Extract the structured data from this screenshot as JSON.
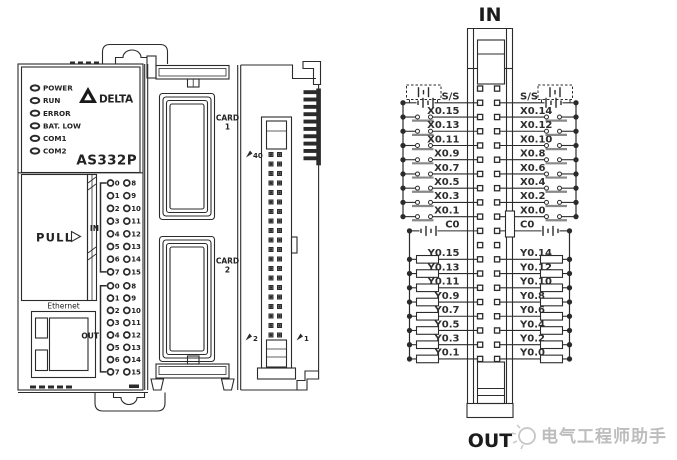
{
  "device": {
    "brand": "DELTA",
    "model": "AS332P",
    "status_leds": [
      "POWER",
      "RUN",
      "ERROR",
      "BAT. LOW",
      "COM1",
      "COM2"
    ],
    "pull_label": "PULL",
    "ethernet_label": "Ethernet",
    "in_group_label": "IN",
    "out_group_label": "OUT",
    "led_numbers_col1": [
      "0",
      "1",
      "2",
      "3",
      "4",
      "5",
      "6",
      "7"
    ],
    "led_numbers_col2": [
      "8",
      "9",
      "10",
      "11",
      "12",
      "13",
      "14",
      "15"
    ],
    "card1_line1": "CARD",
    "card1_line2": "1",
    "card2_line1": "CARD",
    "card2_line2": "2",
    "pin40_marker": "40",
    "pin2_marker": "2",
    "pin1_marker": "1"
  },
  "wiring": {
    "in_title": "IN",
    "out_title": "OUT",
    "left_labels": [
      "S/S",
      "X0.15",
      "X0.13",
      "X0.11",
      "X0.9",
      "X0.7",
      "X0.5",
      "X0.3",
      "X0.1",
      "C0",
      "Y0.15",
      "Y0.13",
      "Y0.11",
      "Y0.9",
      "Y0.7",
      "Y0.5",
      "Y0.3",
      "Y0.1"
    ],
    "right_labels": [
      "S/S",
      "X0.14",
      "X0.12",
      "X0.10",
      "X0.8",
      "X0.6",
      "X0.4",
      "X0.2",
      "X0.0",
      "C0",
      "Y0.14",
      "Y0.12",
      "Y0.10",
      "Y0.8",
      "Y0.6",
      "Y0.4",
      "Y0.2",
      "Y0.0"
    ]
  },
  "watermark": {
    "text": "电气工程师助手"
  },
  "colors": {
    "line": "#2b2b2b",
    "text": "#222222",
    "watermark": "#bdbdbd"
  }
}
